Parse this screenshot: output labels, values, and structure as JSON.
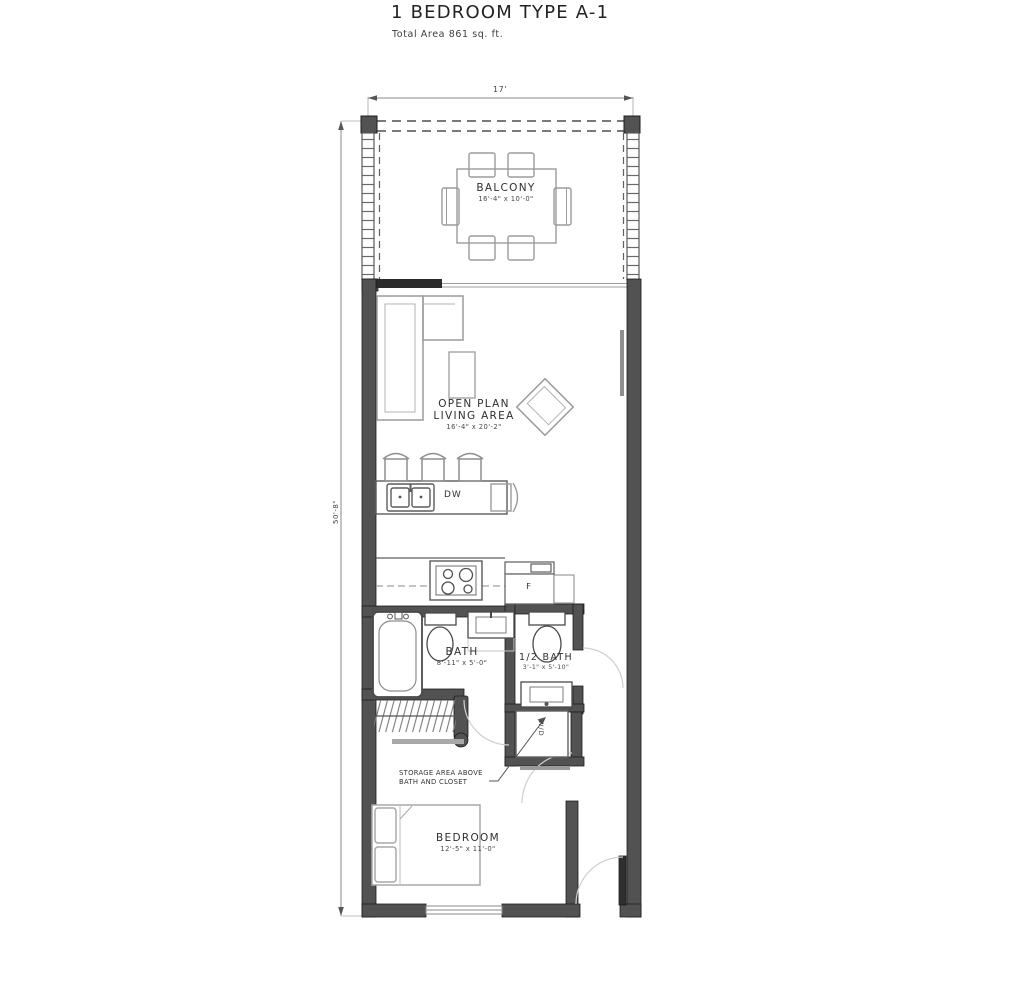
{
  "title": "1 BEDROOM TYPE A-1",
  "subtitle": "Total Area 861 sq. ft.",
  "dimensions": {
    "width_top": "17'",
    "height_left": "50'-8\""
  },
  "rooms": {
    "balcony": {
      "name": "BALCONY",
      "size": "16'-4\" x 10'-0\""
    },
    "living": {
      "name": "OPEN PLAN LIVING AREA",
      "size": "16'-4\" x 20'-2\""
    },
    "bath": {
      "name": "BATH",
      "size": "8'-11\" x 5'-0\""
    },
    "half_bath": {
      "name": "1/2 BATH",
      "size": "3'-1\" x 5'-10\""
    },
    "bedroom": {
      "name": "BEDROOM",
      "size": "12'-5\" x 11'-0\""
    }
  },
  "labels": {
    "dishwasher": "DW",
    "fridge": "F",
    "washer_dryer": "W/D",
    "storage_note_line1": "STORAGE AREA ABOVE",
    "storage_note_line2": "BATH AND CLOSET"
  },
  "colors": {
    "wall": "#525252",
    "line-dark": "#4a4a4a",
    "line-mid": "#8a8a8a",
    "line-light": "#cfcfcf",
    "text": "#2f2f2f",
    "bg": "#ffffff"
  }
}
